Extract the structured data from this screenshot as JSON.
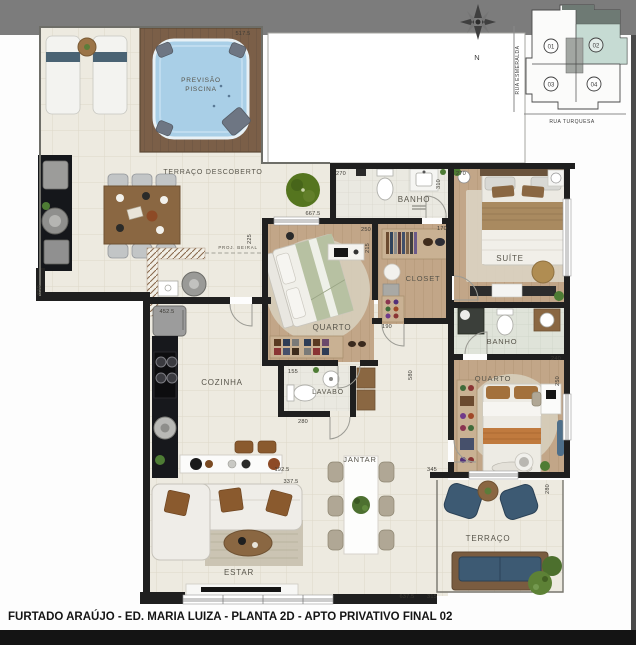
{
  "footer": {
    "text": "FURTADO ARAÚJO - ED. MARIA LUIZA - PLANTA 2D - APTO PRIVATIVO FINAL 02"
  },
  "key_plan": {
    "street_left": "RUA ESMERALDA",
    "street_bottom": "RUA TURQUESA",
    "compass": "N",
    "units": [
      "01",
      "02",
      "03",
      "04"
    ],
    "highlighted_unit": "02"
  },
  "rooms": {
    "terraco_descoberto": "TERRAÇO DESCOBERTO",
    "pool_line1": "PREVISÃO",
    "pool_line2": "PISCINA",
    "banho1": "BANHO",
    "suite": "SUÍTE",
    "closet": "CLOSET",
    "quarto1": "QUARTO",
    "cozinha": "COZINHA",
    "lavabo": "LAVABO",
    "jantar": "JANTAR",
    "estar": "ESTAR",
    "banho2": "BANHO",
    "quarto2": "QUARTO",
    "terraco": "TERRAÇO",
    "proj_beiral": "PROJ. BEIRAL"
  },
  "dims": [
    "517.5",
    "667.5",
    "630",
    "270",
    "310",
    "270",
    "250",
    "215",
    "170",
    "190",
    "155",
    "280",
    "580",
    "240",
    "250",
    "345",
    "280",
    "637.5",
    "315",
    "337.5",
    "192.5",
    "452.5",
    "225"
  ],
  "colors": {
    "top_band": "#7c7c7c",
    "wall": "#1f1f1f",
    "unit_highlight": "#c6dbd3",
    "pool_water": "#a9cfe7",
    "terrace_furniture_blue": "#3d5a73",
    "wood_floor": "#c2a688"
  }
}
